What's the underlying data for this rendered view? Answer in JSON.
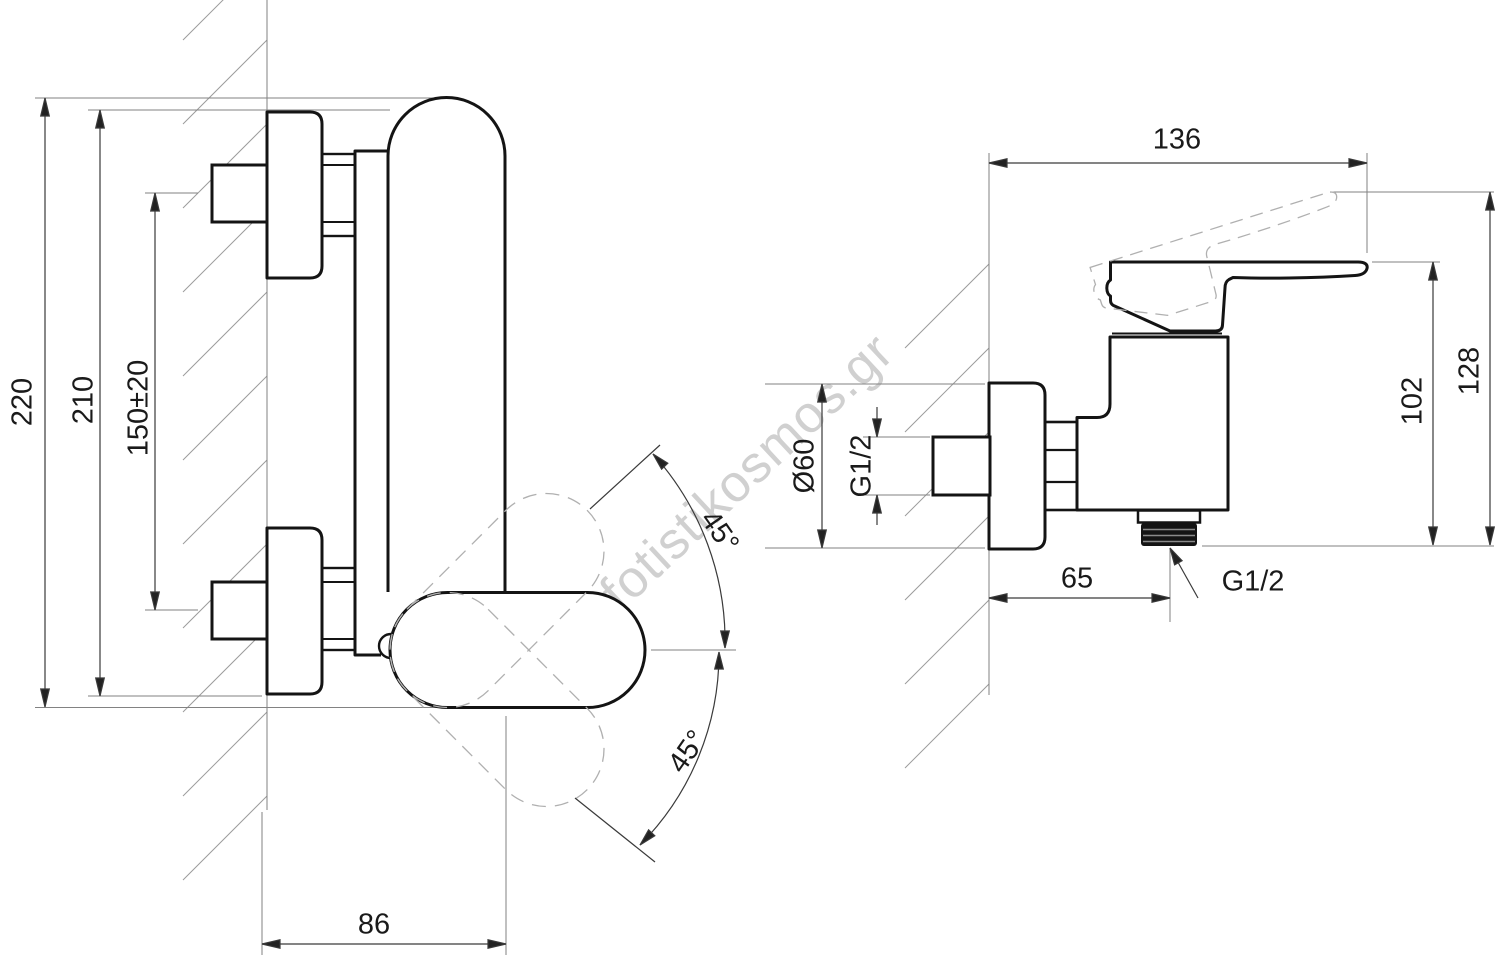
{
  "watermark": "fotistikosmos.gr",
  "colors": {
    "outline": "#141414",
    "dim_line": "#3a3a3a",
    "thin_line": "#828282",
    "hatch": "#9c9c9c",
    "phantom": "#b0b0b0",
    "watermark": "#d0d0d0",
    "background": "#ffffff"
  },
  "side_view": {
    "dim_height_overall": "220",
    "dim_height_escutcheons": "210",
    "dim_inlet_spacing": "150±20",
    "dim_depth": "86",
    "dim_angle_up": "45°",
    "dim_angle_down": "45°"
  },
  "front_view": {
    "dim_width_overall": "136",
    "dim_height_handle_raised": "128",
    "dim_height_handle": "102",
    "dim_escutcheon_diameter": "Ø60",
    "dim_inlet_thread": "G1/2",
    "dim_outlet_offset": "65",
    "dim_outlet_thread": "G1/2"
  }
}
